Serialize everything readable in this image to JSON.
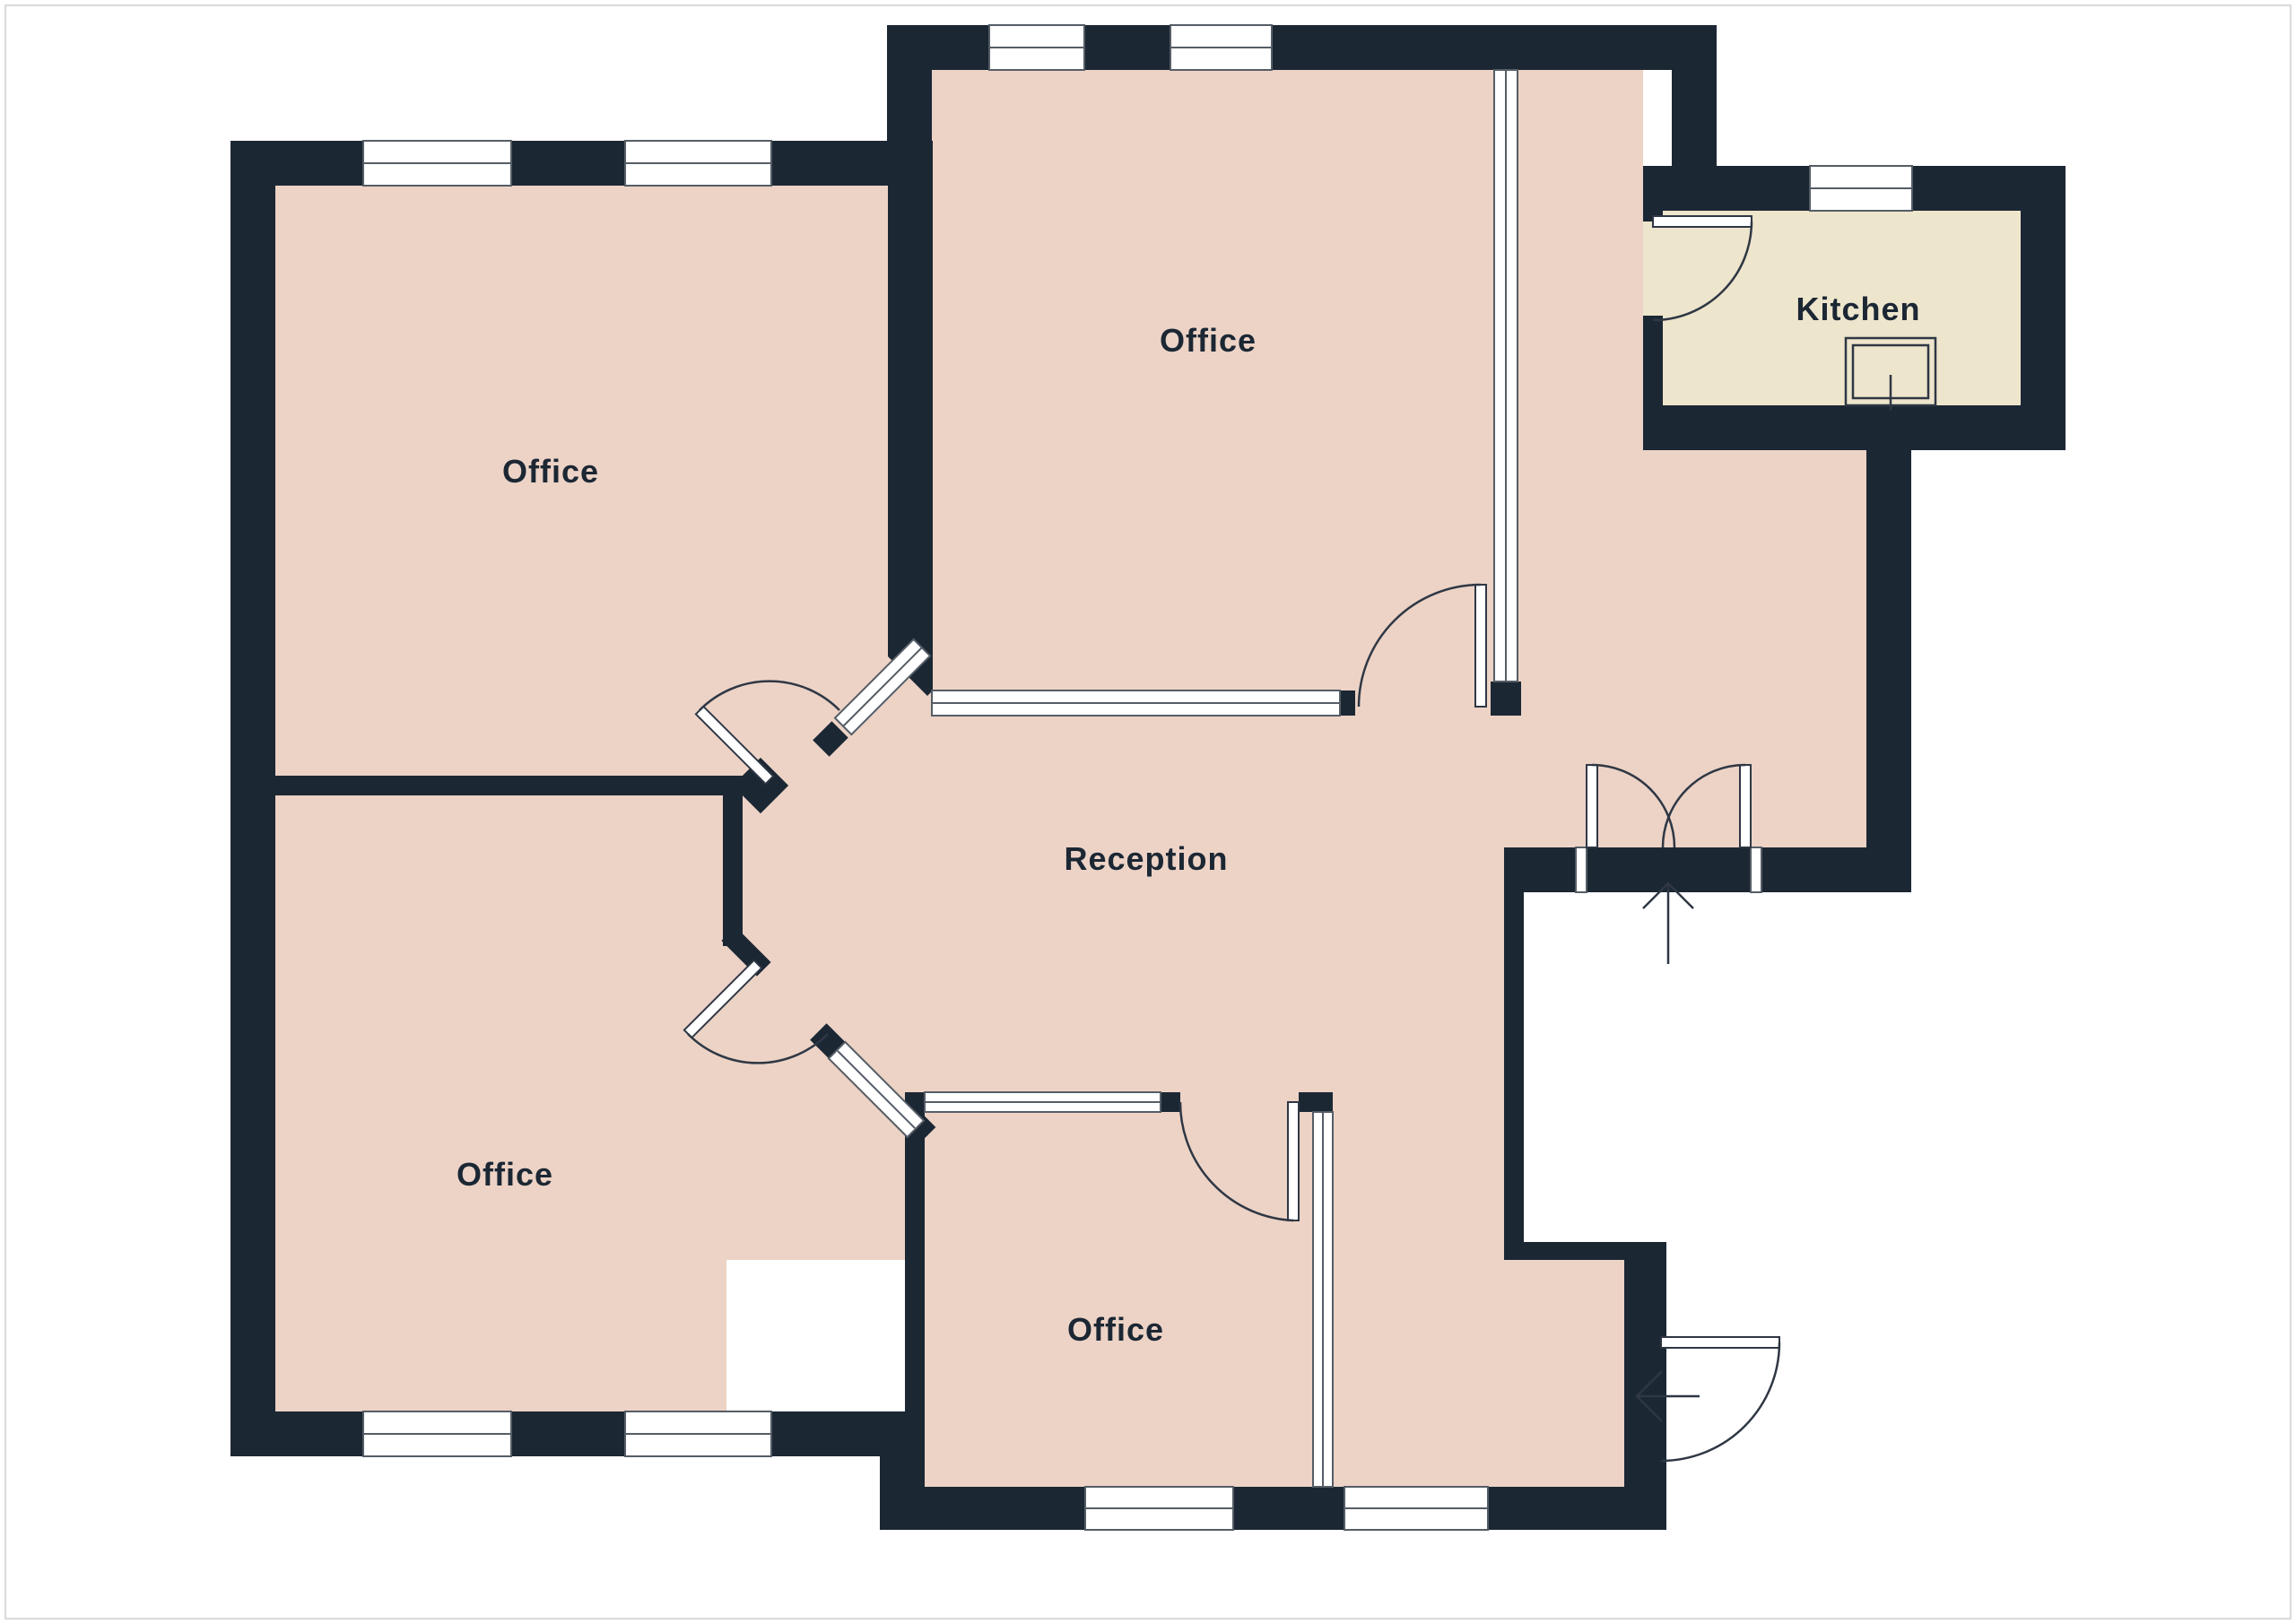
{
  "colors": {
    "wall": "#1c2734",
    "room": "#ecd3c6",
    "kitchen": "#ede5cc",
    "outline": "#2f3744",
    "frame": "#555d66",
    "background": "#ffffff",
    "border": "#d9dadb"
  },
  "rooms": [
    {
      "id": "office-top-left",
      "label": "Office"
    },
    {
      "id": "office-top",
      "label": "Office"
    },
    {
      "id": "kitchen",
      "label": "Kitchen"
    },
    {
      "id": "reception",
      "label": "Reception"
    },
    {
      "id": "office-bottom-left",
      "label": "Office"
    },
    {
      "id": "office-bottom",
      "label": "Office"
    }
  ],
  "icons": {
    "main_entrance": "arrow-up-icon",
    "side_entrance": "arrow-left-icon"
  }
}
